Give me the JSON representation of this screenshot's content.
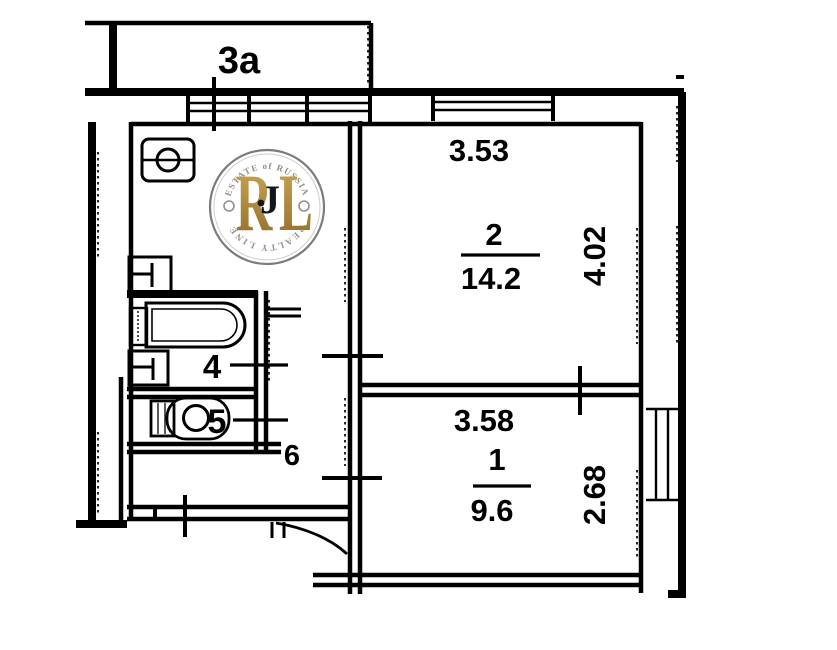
{
  "plan": {
    "balcony_label": "3a",
    "room2": {
      "number": "2",
      "area": "14.2",
      "width": "3.53",
      "depth": "4.02"
    },
    "room1": {
      "number": "1",
      "area": "9.6",
      "width": "3.58",
      "depth": "2.68"
    },
    "bathroom_number": "4",
    "toilet_number": "5",
    "hallway_number": "6",
    "obscured_glyph": "J"
  },
  "watermark": {
    "arc_top": "ESTATE of RUSSIA",
    "arc_bottom": "REALTY LINE",
    "letter_r": "R",
    "letter_l": "L"
  },
  "colors": {
    "ink": "#000000",
    "paper": "#ffffff",
    "gold_light": "#d2ab57",
    "gold_dark": "#8d6a29",
    "ring": "#7d7c78",
    "ring_inner": "#cfcdc8",
    "arc_text": "#94918b",
    "glyph_dark": "#15151c"
  }
}
